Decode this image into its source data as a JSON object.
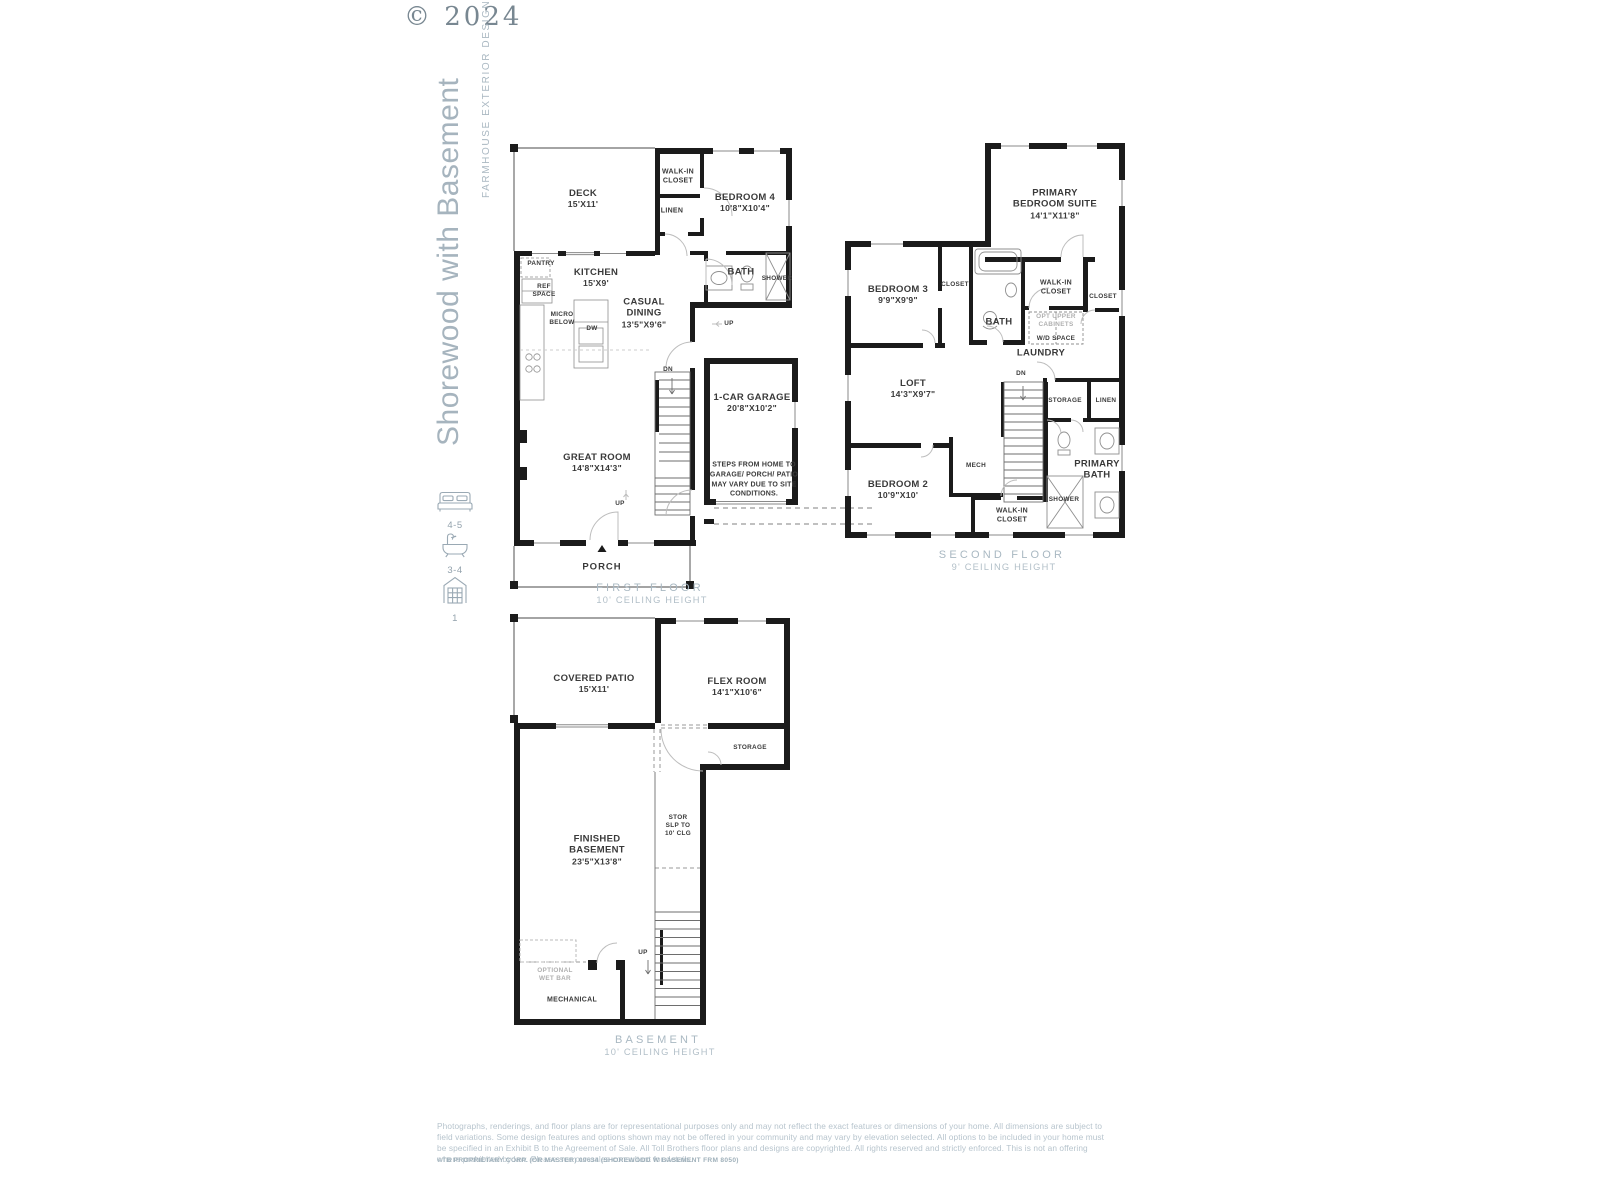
{
  "header": {
    "copyright": "© 2024",
    "title": "Shorewood with Basement",
    "subtitle": "FARMHOUSE EXTERIOR DESIGN"
  },
  "summary": {
    "beds": "4-5",
    "baths": "3-4",
    "garages": "1"
  },
  "first_floor": {
    "title": "FIRST FLOOR",
    "ceiling": "10' CEILING HEIGHT",
    "deck_name": "DECK",
    "deck_dim": "15'X11'",
    "walkin_closet": "WALK-IN CLOSET",
    "linen": "LINEN",
    "bedroom4_name": "BEDROOM 4",
    "bedroom4_dim": "10'8\"X10'4\"",
    "pantry": "PANTRY",
    "ref_space": "REF SPACE",
    "kitchen_name": "KITCHEN",
    "kitchen_dim": "15'X9'",
    "micro": "MICRO BELOW",
    "dw": "DW",
    "bath": "BATH",
    "shower": "SHOWER",
    "up_small": "UP",
    "casual_name": "CASUAL DINING",
    "casual_dim": "13'5\"X9'6\"",
    "dn": "DN",
    "garage_name": "1-CAR GARAGE",
    "garage_dim": "20'8\"X10'2\"",
    "great_name": "GREAT ROOM",
    "great_dim": "14'8\"X14'3\"",
    "steps_note": "STEPS FROM HOME TO GARAGE/ PORCH/ PATIO MAY VARY DUE TO SITE CONDITIONS.",
    "up": "UP",
    "porch": "PORCH"
  },
  "second_floor": {
    "title": "SECOND FLOOR",
    "ceiling": "9' CEILING HEIGHT",
    "primary_name": "PRIMARY BEDROOM SUITE",
    "primary_dim": "14'1\"X11'8\"",
    "bedroom3_name": "BEDROOM 3",
    "bedroom3_dim": "9'9\"X9'9\"",
    "closet": "CLOSET",
    "bath": "BATH",
    "walkin_closet": "WALK-IN CLOSET",
    "opt_cabinets": "OPT UPPER CABINETS",
    "wd_space": "W/D SPACE",
    "closet2": "CLOSET",
    "laundry": "LAUNDRY",
    "loft_name": "LOFT",
    "loft_dim": "14'3\"X9'7\"",
    "dn": "DN",
    "storage": "STORAGE",
    "linen": "LINEN",
    "mech": "MECH",
    "bedroom2_name": "BEDROOM 2",
    "bedroom2_dim": "10'9\"X10'",
    "walkin_closet2": "WALK-IN CLOSET",
    "shower": "SHOWER",
    "primary_bath": "PRIMARY BATH"
  },
  "basement": {
    "title": "BASEMENT",
    "ceiling": "10' CEILING HEIGHT",
    "patio_name": "COVERED PATIO",
    "patio_dim": "15'X11'",
    "flex_name": "FLEX ROOM",
    "flex_dim": "14'1\"X10'6\"",
    "storage": "STORAGE",
    "stor_slp": "STOR SLP TO 10' CLG",
    "basement_name": "FINISHED BASEMENT",
    "basement_dim": "23'5\"X13'8\"",
    "up": "UP",
    "wet_bar": "OPTIONAL WET BAR",
    "mechanical": "MECHANICAL"
  },
  "footer": {
    "disclaimer": "Photographs, renderings, and floor plans are for representational purposes only and may not reflect the exact features or dimensions of your home. All dimensions are subject to field variations. Some design features and options shown may not be offered in your community and may vary by elevation selected. All options to be included in your home must be specified in an Exhibit B to the Agreement of Sale. All Toll Brothers floor plans and designs are copyrighted. All rights reserved and strictly enforced. This is not an offering where prohibited by law. Please see our sales consultant for details.",
    "proprietary": "©TB PROPRIETARY CORP. (OR MASTER) 09634 (SHOREWOOD W BASEMENT FRM 8050)"
  },
  "colors": {
    "wall": "#1b1b1b",
    "accent_text": "#a9b8c2",
    "label_text": "#3a3a3a"
  }
}
